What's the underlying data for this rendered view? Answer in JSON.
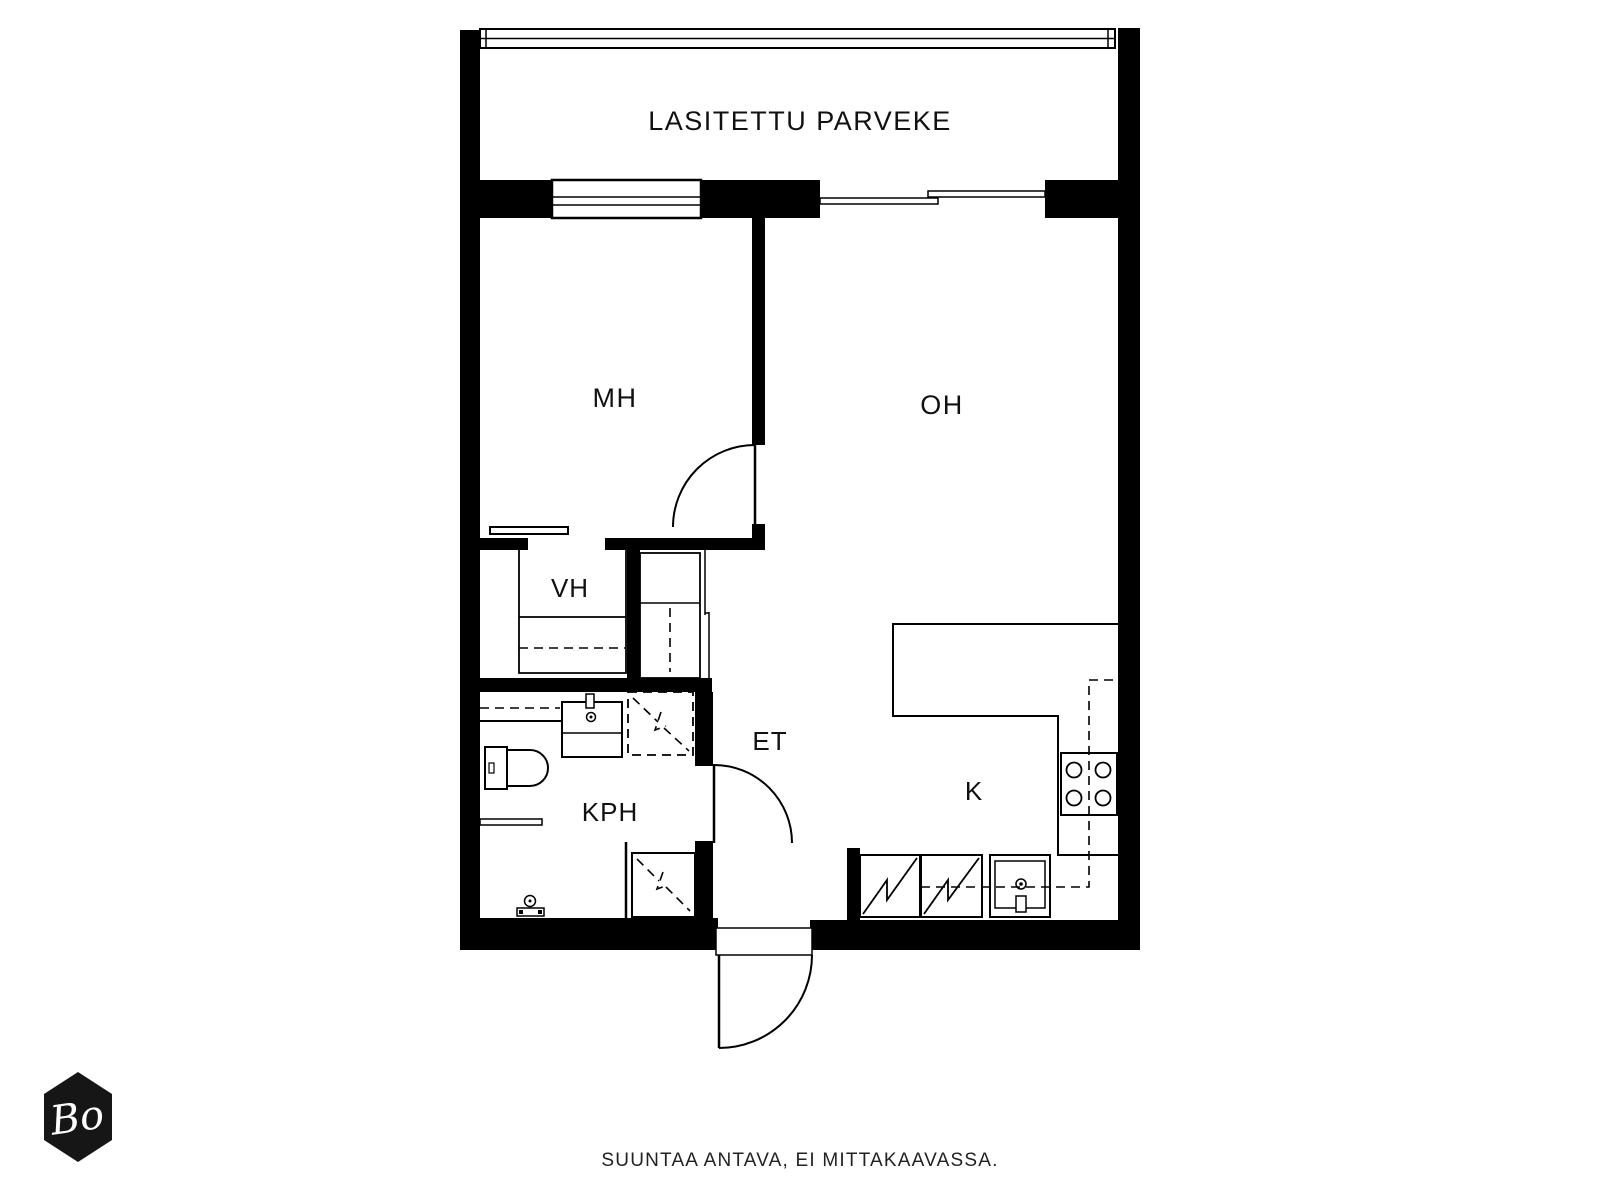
{
  "floorplan": {
    "rooms": {
      "balcony": "LASITETTU PARVEKE",
      "bedroom": "MH",
      "living_room": "OH",
      "closet": "VH",
      "hallway": "ET",
      "bathroom": "KPH",
      "kitchen": "K"
    },
    "caption": "SUUNTAA ANTAVA, EI MITTAKAAVASSA.",
    "logo_text": "Bo",
    "colors": {
      "wall": "#000000",
      "background": "#ffffff",
      "logo_bg": "#161616",
      "logo_text": "#ffffff"
    }
  }
}
